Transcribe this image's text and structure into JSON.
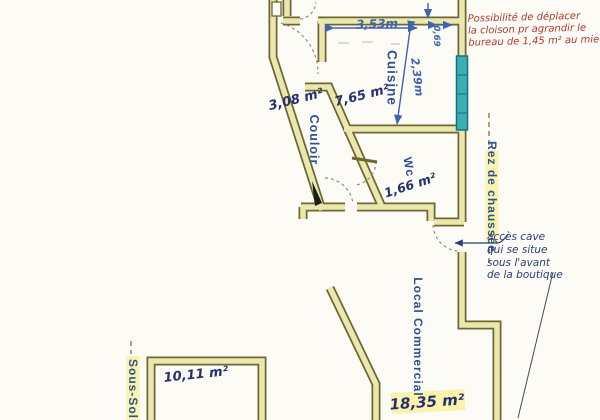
{
  "levels": {
    "ground": "Rez de chaussée",
    "basement": "Sous-Sol"
  },
  "rooms": {
    "cuisine": {
      "label": "Cuisine",
      "area": "7,65 m²"
    },
    "couloir": {
      "label": "Couloir",
      "area": "3,08 m²"
    },
    "wc": {
      "label": "Wc",
      "area": "1,66 m²"
    },
    "local_commercial": {
      "label": "Local Commercial",
      "area": "18,35 m²"
    },
    "basement_room": {
      "area": "10,11 m²"
    }
  },
  "dimensions": {
    "top_width": "3,53m",
    "corner_width": "0,69",
    "kitchen_depth": "2,39m"
  },
  "annotations": {
    "red_note": {
      "color": "#b03a2e",
      "lines": [
        "Possibilité de déplacer",
        "la cloison pr agrandir le",
        "bureau de 1,45 m² au mieux"
      ]
    },
    "cave_note": {
      "color": "#2c3e7b",
      "lines": [
        "accès cave",
        "qui se situe",
        "sous l'avant",
        "de la boutique"
      ]
    }
  },
  "colors": {
    "wall_fill": "#ebe7b0",
    "wall_outline": "#6e672f",
    "window": "#3ab0b4",
    "room_label": "#2d5191",
    "dimension": "#3f63ad",
    "highlight": "#f8f1a0",
    "paper": "#fcfbf6"
  }
}
